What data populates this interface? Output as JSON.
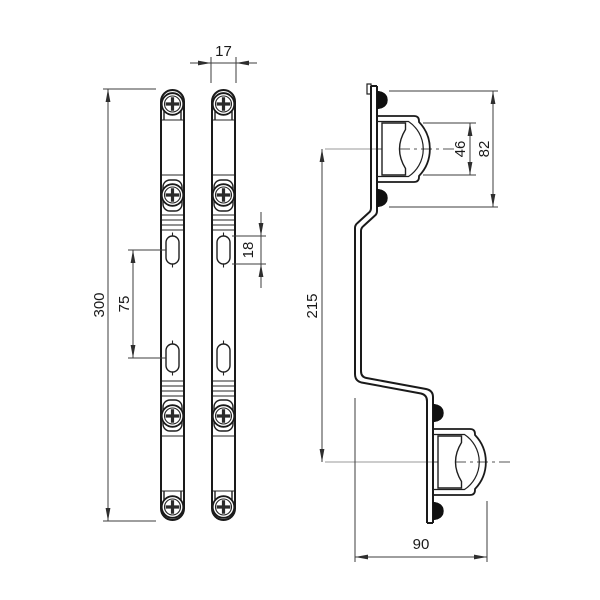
{
  "drawing": {
    "background_color": "#ffffff",
    "line_color": "#1a1a1a",
    "dimension_line_color": "#3d3d3d",
    "centerline_color": "#9a9a9a",
    "dimensions": {
      "bar_width": {
        "value": "17"
      },
      "bar_length": {
        "value": "300"
      },
      "slot_spacing": {
        "value": "75"
      },
      "slot_length": {
        "value": "18"
      },
      "clamp_inner_height": {
        "value": "46"
      },
      "clamp_overall_height": {
        "value": "82"
      },
      "clamp_center_spacing": {
        "value": "215"
      },
      "bracket_depth": {
        "value": "90"
      }
    }
  }
}
